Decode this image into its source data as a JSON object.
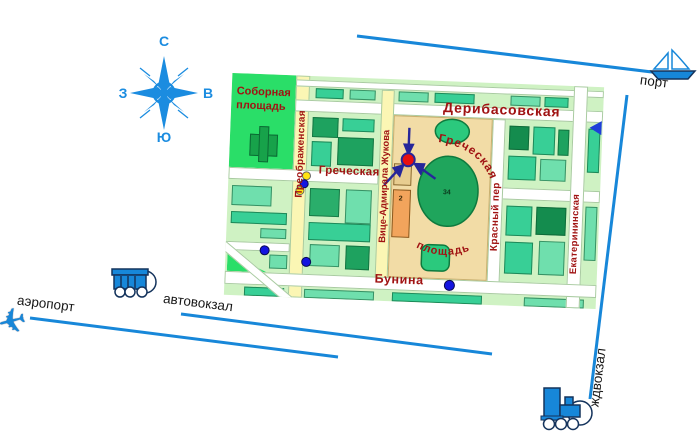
{
  "page": {
    "background": "#FFFFFF"
  },
  "colors": {
    "line_blue": "#1787D9",
    "compass_blue": "#1B8CE0",
    "map_label_red": "#A01313",
    "marker_red": "#E81010",
    "arrow_navy": "#26269A",
    "square_tan": "#F2DCA6",
    "park_green": "#2ADE68",
    "dot_blue": "#1414E0",
    "dot_yellow": "#FFE312"
  },
  "compass": {
    "north": "С",
    "south": "Ю",
    "west": "З",
    "east": "В"
  },
  "transport": {
    "port": "порт",
    "airport": "аэропорт",
    "bus_station": "автовокзал",
    "rail_station": "ждвокзал"
  },
  "map": {
    "park_square": "Соборная площадь",
    "streets": {
      "preobrazhenskaya": "Преображенская",
      "deribasovskaya": "Дерибасовская",
      "grecheskaya": "Греческая",
      "vice_admirala_zhukova": "Вице-Адмирала Жукова",
      "krasny_per": "Красный пер",
      "ekaterininskaya": "Екатерининская",
      "bunina": "Бунина"
    },
    "square": {
      "line1": "Греческая",
      "line2": "площадь",
      "oval_number": "34",
      "building_number": "2"
    }
  }
}
